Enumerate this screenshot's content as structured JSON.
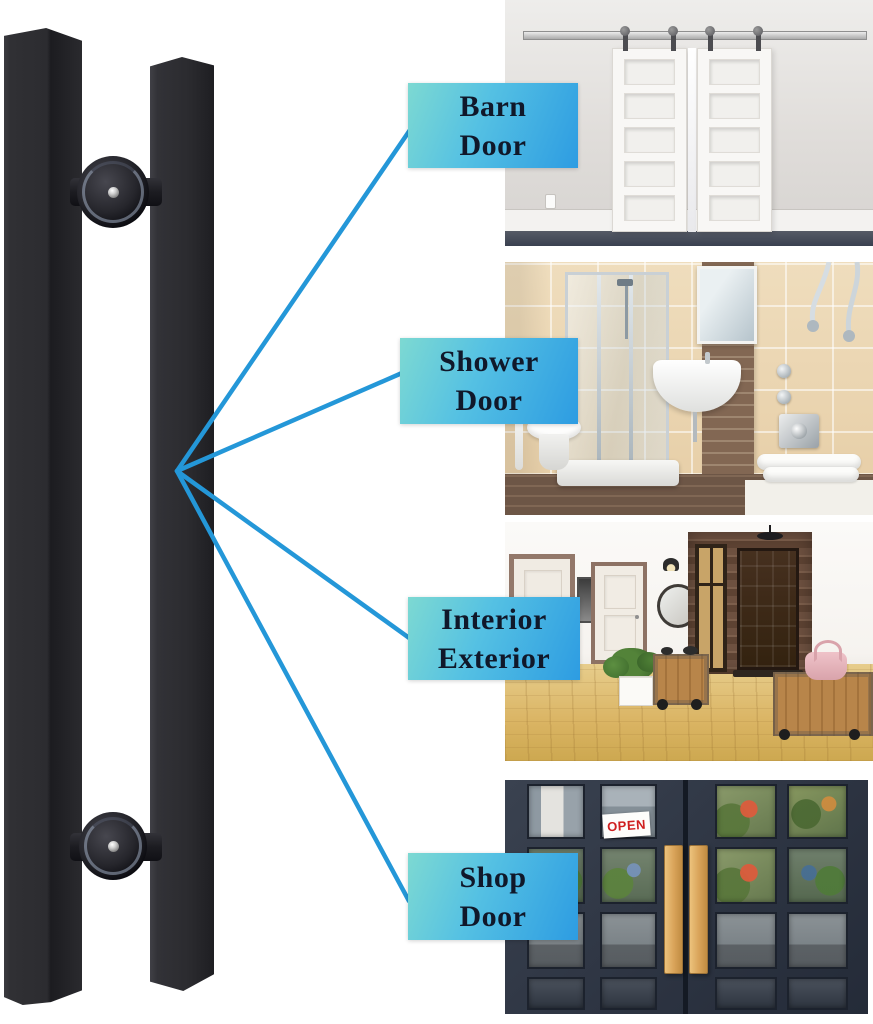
{
  "labels": [
    {
      "id": "barn-door",
      "line1": "Barn",
      "line2": "Door"
    },
    {
      "id": "shower-door",
      "line1": "Shower",
      "line2": "Door"
    },
    {
      "id": "interior-exterior",
      "line1": "Interior",
      "line2": "Exterior"
    },
    {
      "id": "shop-door",
      "line1": "Shop",
      "line2": "Door"
    }
  ],
  "shop_photo": {
    "open_sign_text": "OPEN"
  },
  "colors": {
    "label_gradient_start": "#7dd9d2",
    "label_gradient_end": "#2d9ce2",
    "label_text": "#10182a",
    "connector_line": "#2497d8",
    "handle_black": "#2b2b2f",
    "shop_handle_wood": "#d8a258",
    "open_sign_red": "#cf1f1f"
  }
}
